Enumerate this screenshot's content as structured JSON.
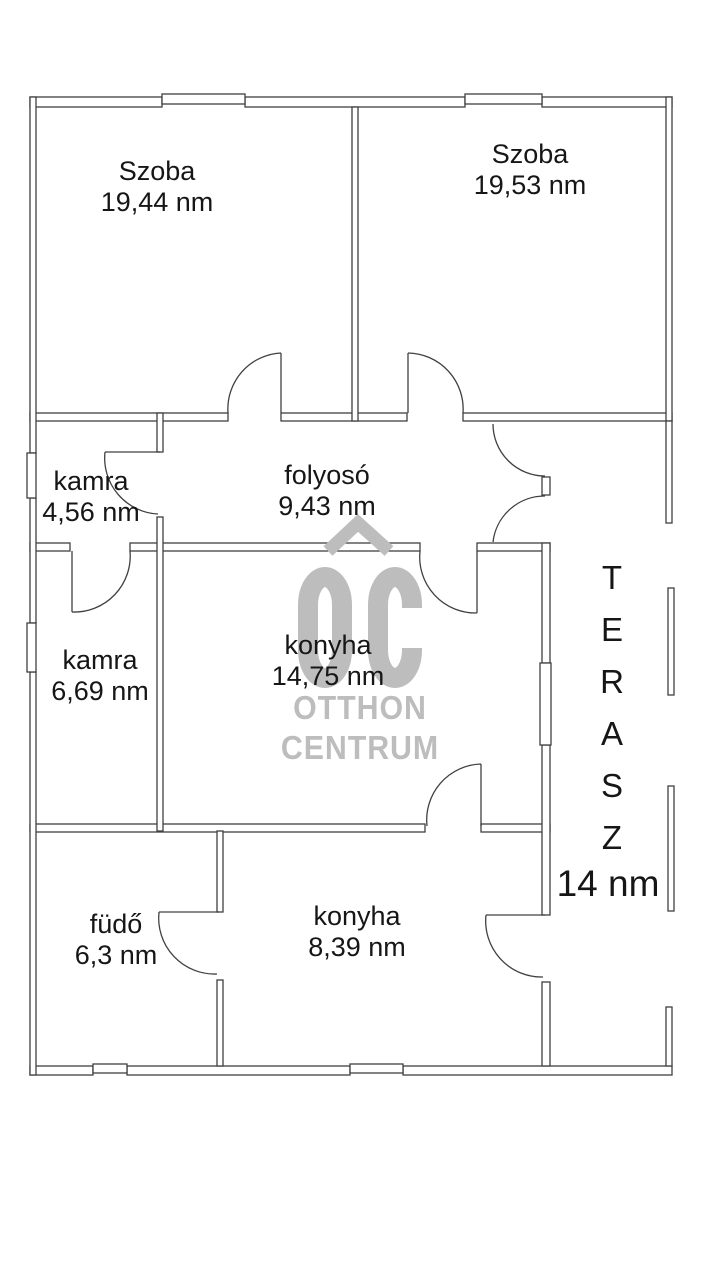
{
  "title": "apartment floor plan",
  "rooms": [
    {
      "name": "Szoba",
      "area": "19,44 nm"
    },
    {
      "name": "Szoba",
      "area": "19,53 nm"
    },
    {
      "name": "kamra",
      "area": "4,56 nm"
    },
    {
      "name": "folyosó",
      "area": "9,43 nm"
    },
    {
      "name": "kamra",
      "area": "6,69 nm"
    },
    {
      "name": "konyha",
      "area": "14,75 nm"
    },
    {
      "name": "füdő",
      "area": "6,3 nm"
    },
    {
      "name": "konyha",
      "area": "8,39 nm"
    }
  ],
  "terasz": {
    "name": "TERASZ",
    "letters": [
      "T",
      "E",
      "R",
      "A",
      "S",
      "Z"
    ],
    "area": "14 nm"
  },
  "watermark": {
    "logo": "OC",
    "line1": "OTTHON",
    "line2": "CENTRUM"
  },
  "colors": {
    "wall_line": "#404040",
    "watermark_gray": "#bdbdbd",
    "label_text": "#161616",
    "background": "#ffffff"
  }
}
